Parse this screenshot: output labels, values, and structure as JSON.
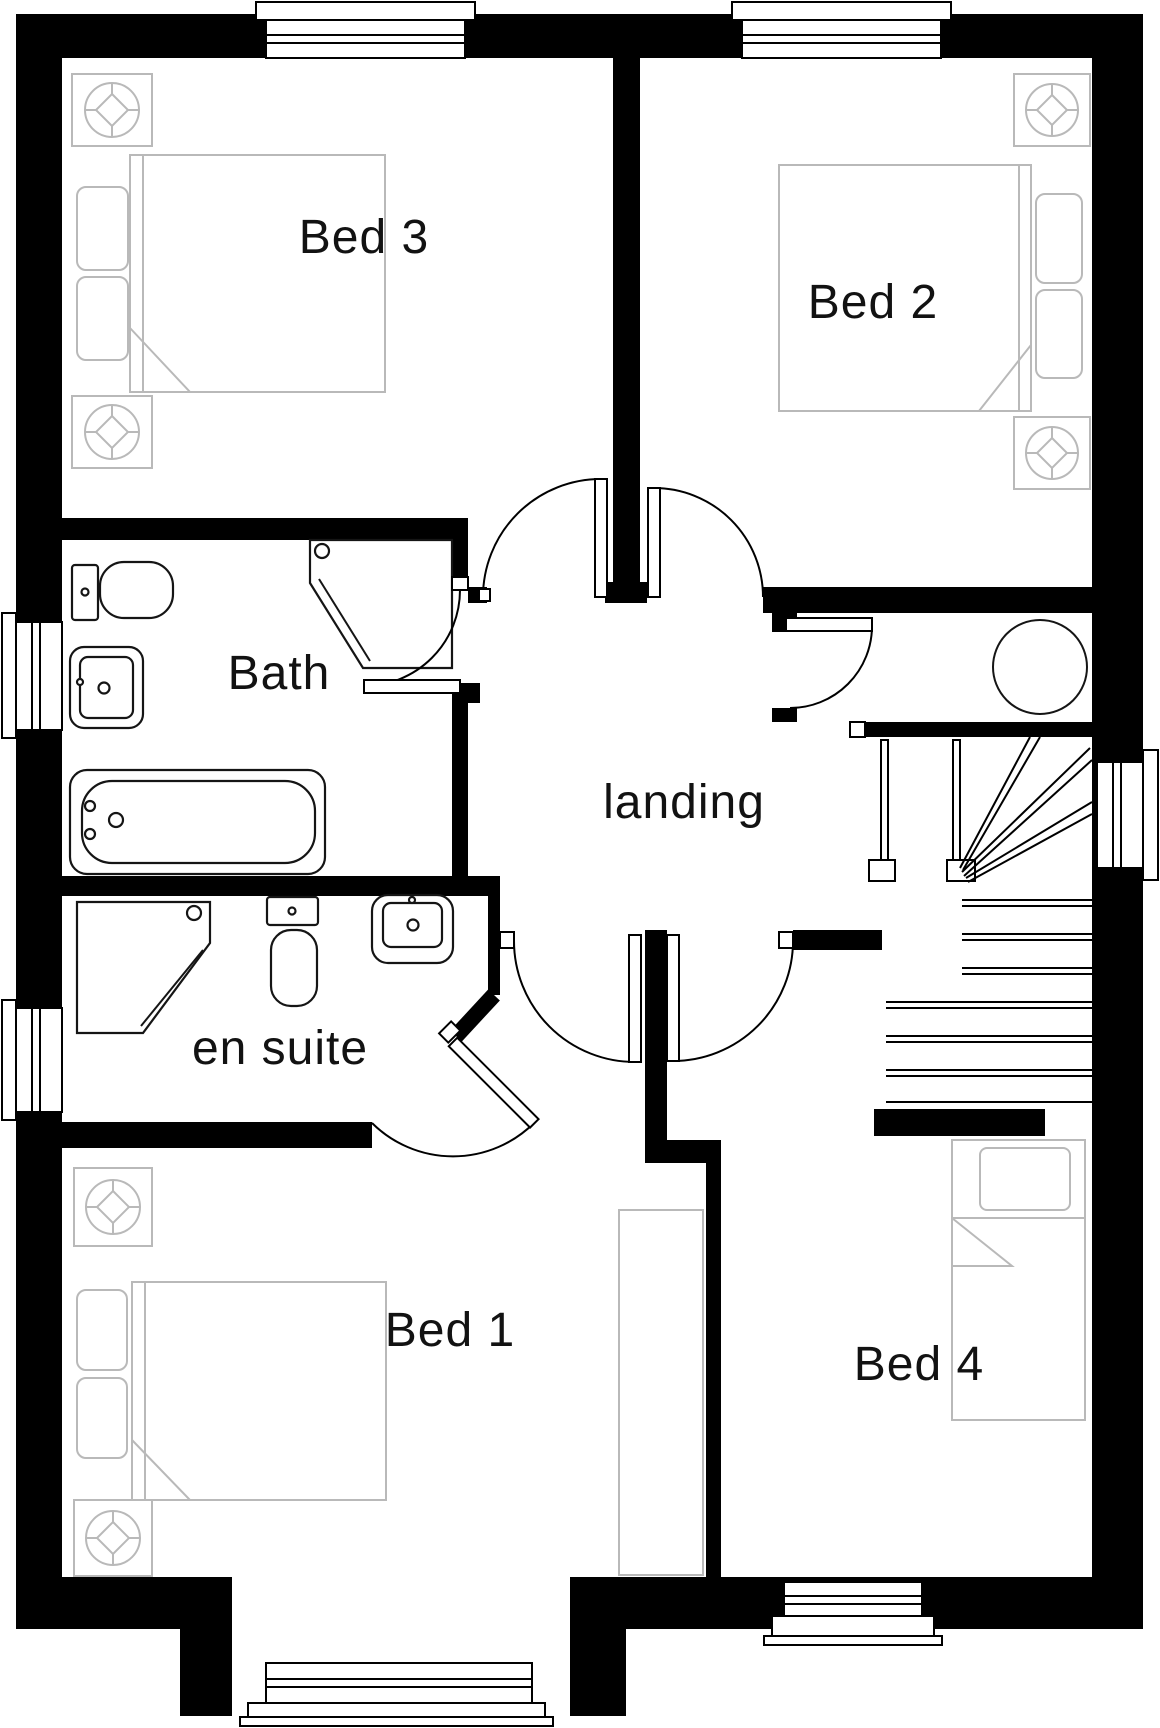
{
  "floor_plan": {
    "title": "first floor plan",
    "labels": {
      "bed3": "Bed 3",
      "bed2": "Bed 2",
      "bath": "Bath",
      "landing": "landing",
      "en_suite": "en suite",
      "bed1": "Bed 1",
      "bed4": "Bed 4"
    },
    "rooms": [
      {
        "id": "bed3",
        "label": "Bed 3",
        "features": [
          "double-bed",
          "two-bedside-tables",
          "top-window"
        ]
      },
      {
        "id": "bed2",
        "label": "Bed 2",
        "features": [
          "double-bed",
          "two-bedside-tables",
          "top-window"
        ]
      },
      {
        "id": "bath",
        "label": "Bath",
        "features": [
          "bathtub",
          "washbasin",
          "toilet",
          "corner-shower",
          "left-window"
        ]
      },
      {
        "id": "landing",
        "label": "landing",
        "features": [
          "staircase",
          "airing-cupboard",
          "hot-water-cylinder"
        ]
      },
      {
        "id": "en_suite",
        "label": "en suite",
        "features": [
          "corner-shower",
          "toilet",
          "washbasin",
          "left-window"
        ]
      },
      {
        "id": "bed1",
        "label": "Bed 1",
        "features": [
          "double-bed",
          "two-bedside-tables",
          "wardrobe",
          "bay-window"
        ]
      },
      {
        "id": "bed4",
        "label": "Bed 4",
        "features": [
          "single-bed",
          "bottom-window"
        ]
      }
    ],
    "door_count": 7,
    "window_count": 7,
    "colors": {
      "walls": "#000000",
      "furniture_outline": "#b9b9b9",
      "fixture_outline": "#151515",
      "background": "#ffffff"
    }
  }
}
